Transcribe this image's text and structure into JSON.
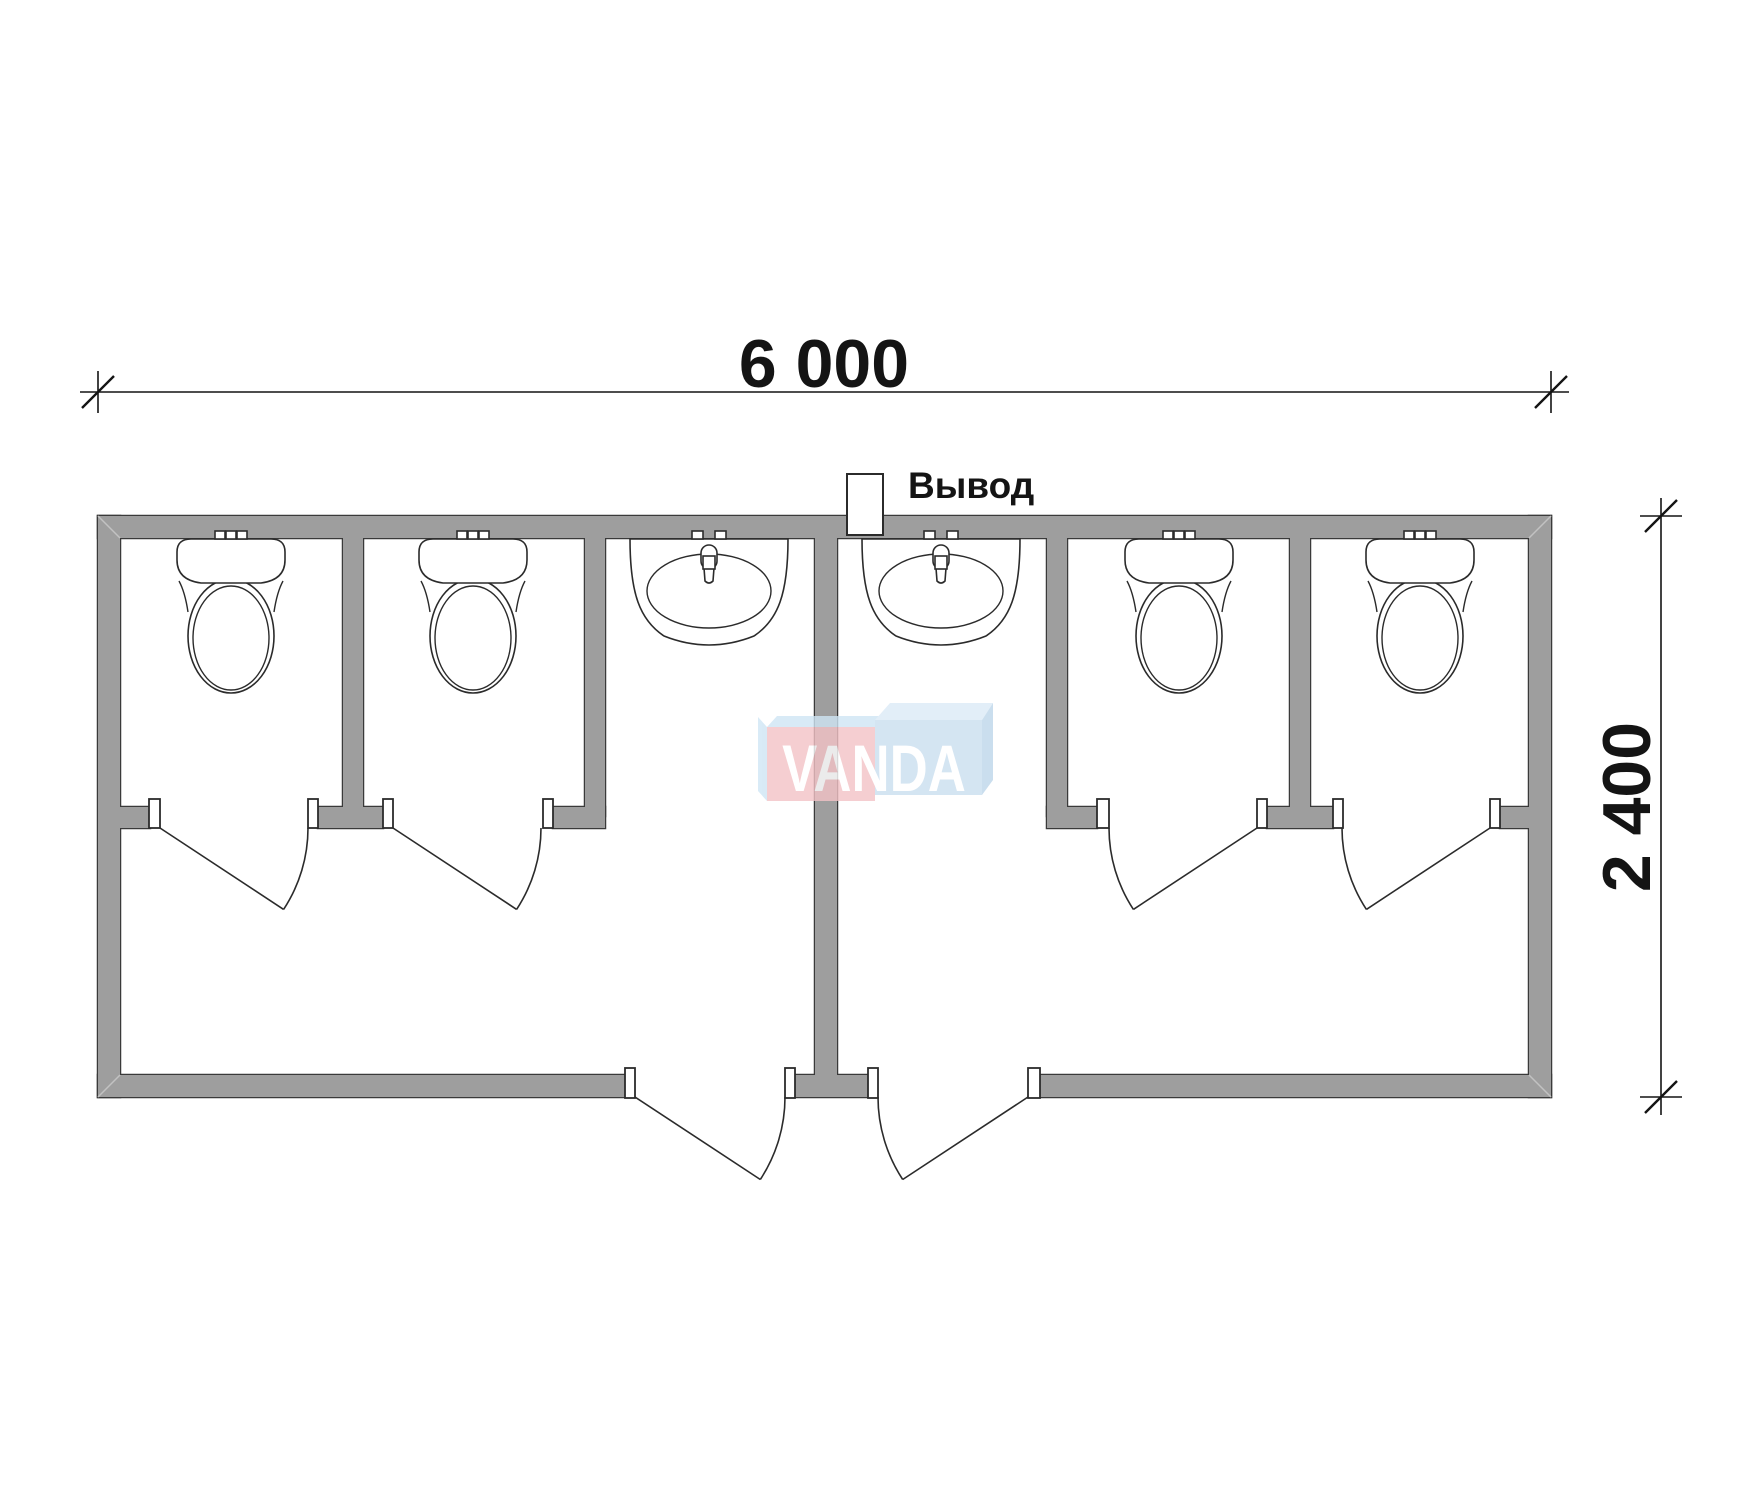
{
  "drawing": {
    "type": "sanitary-container-floor-plan",
    "width_dimension_label": "6 000",
    "height_dimension_label": "2 400",
    "outlet_label": "Вывод",
    "watermark_label": "VANDA"
  },
  "fixtures": {
    "toilets": 4,
    "sinks": 2,
    "stall_doors": 4,
    "entrance_doors": 2
  },
  "colors": {
    "wall": "#9e9e9e",
    "wall_outline": "#3a3a3a",
    "line": "#2b2b2b",
    "dimension": "#141414",
    "logo_pink": "#f3c3c6",
    "logo_blue": "#cadff0",
    "logo_blue_light": "#dcebf7",
    "logo_bevel": "#cfe6f5",
    "logo_side": "#bdd6ea",
    "logo_text": "#ffffff"
  }
}
